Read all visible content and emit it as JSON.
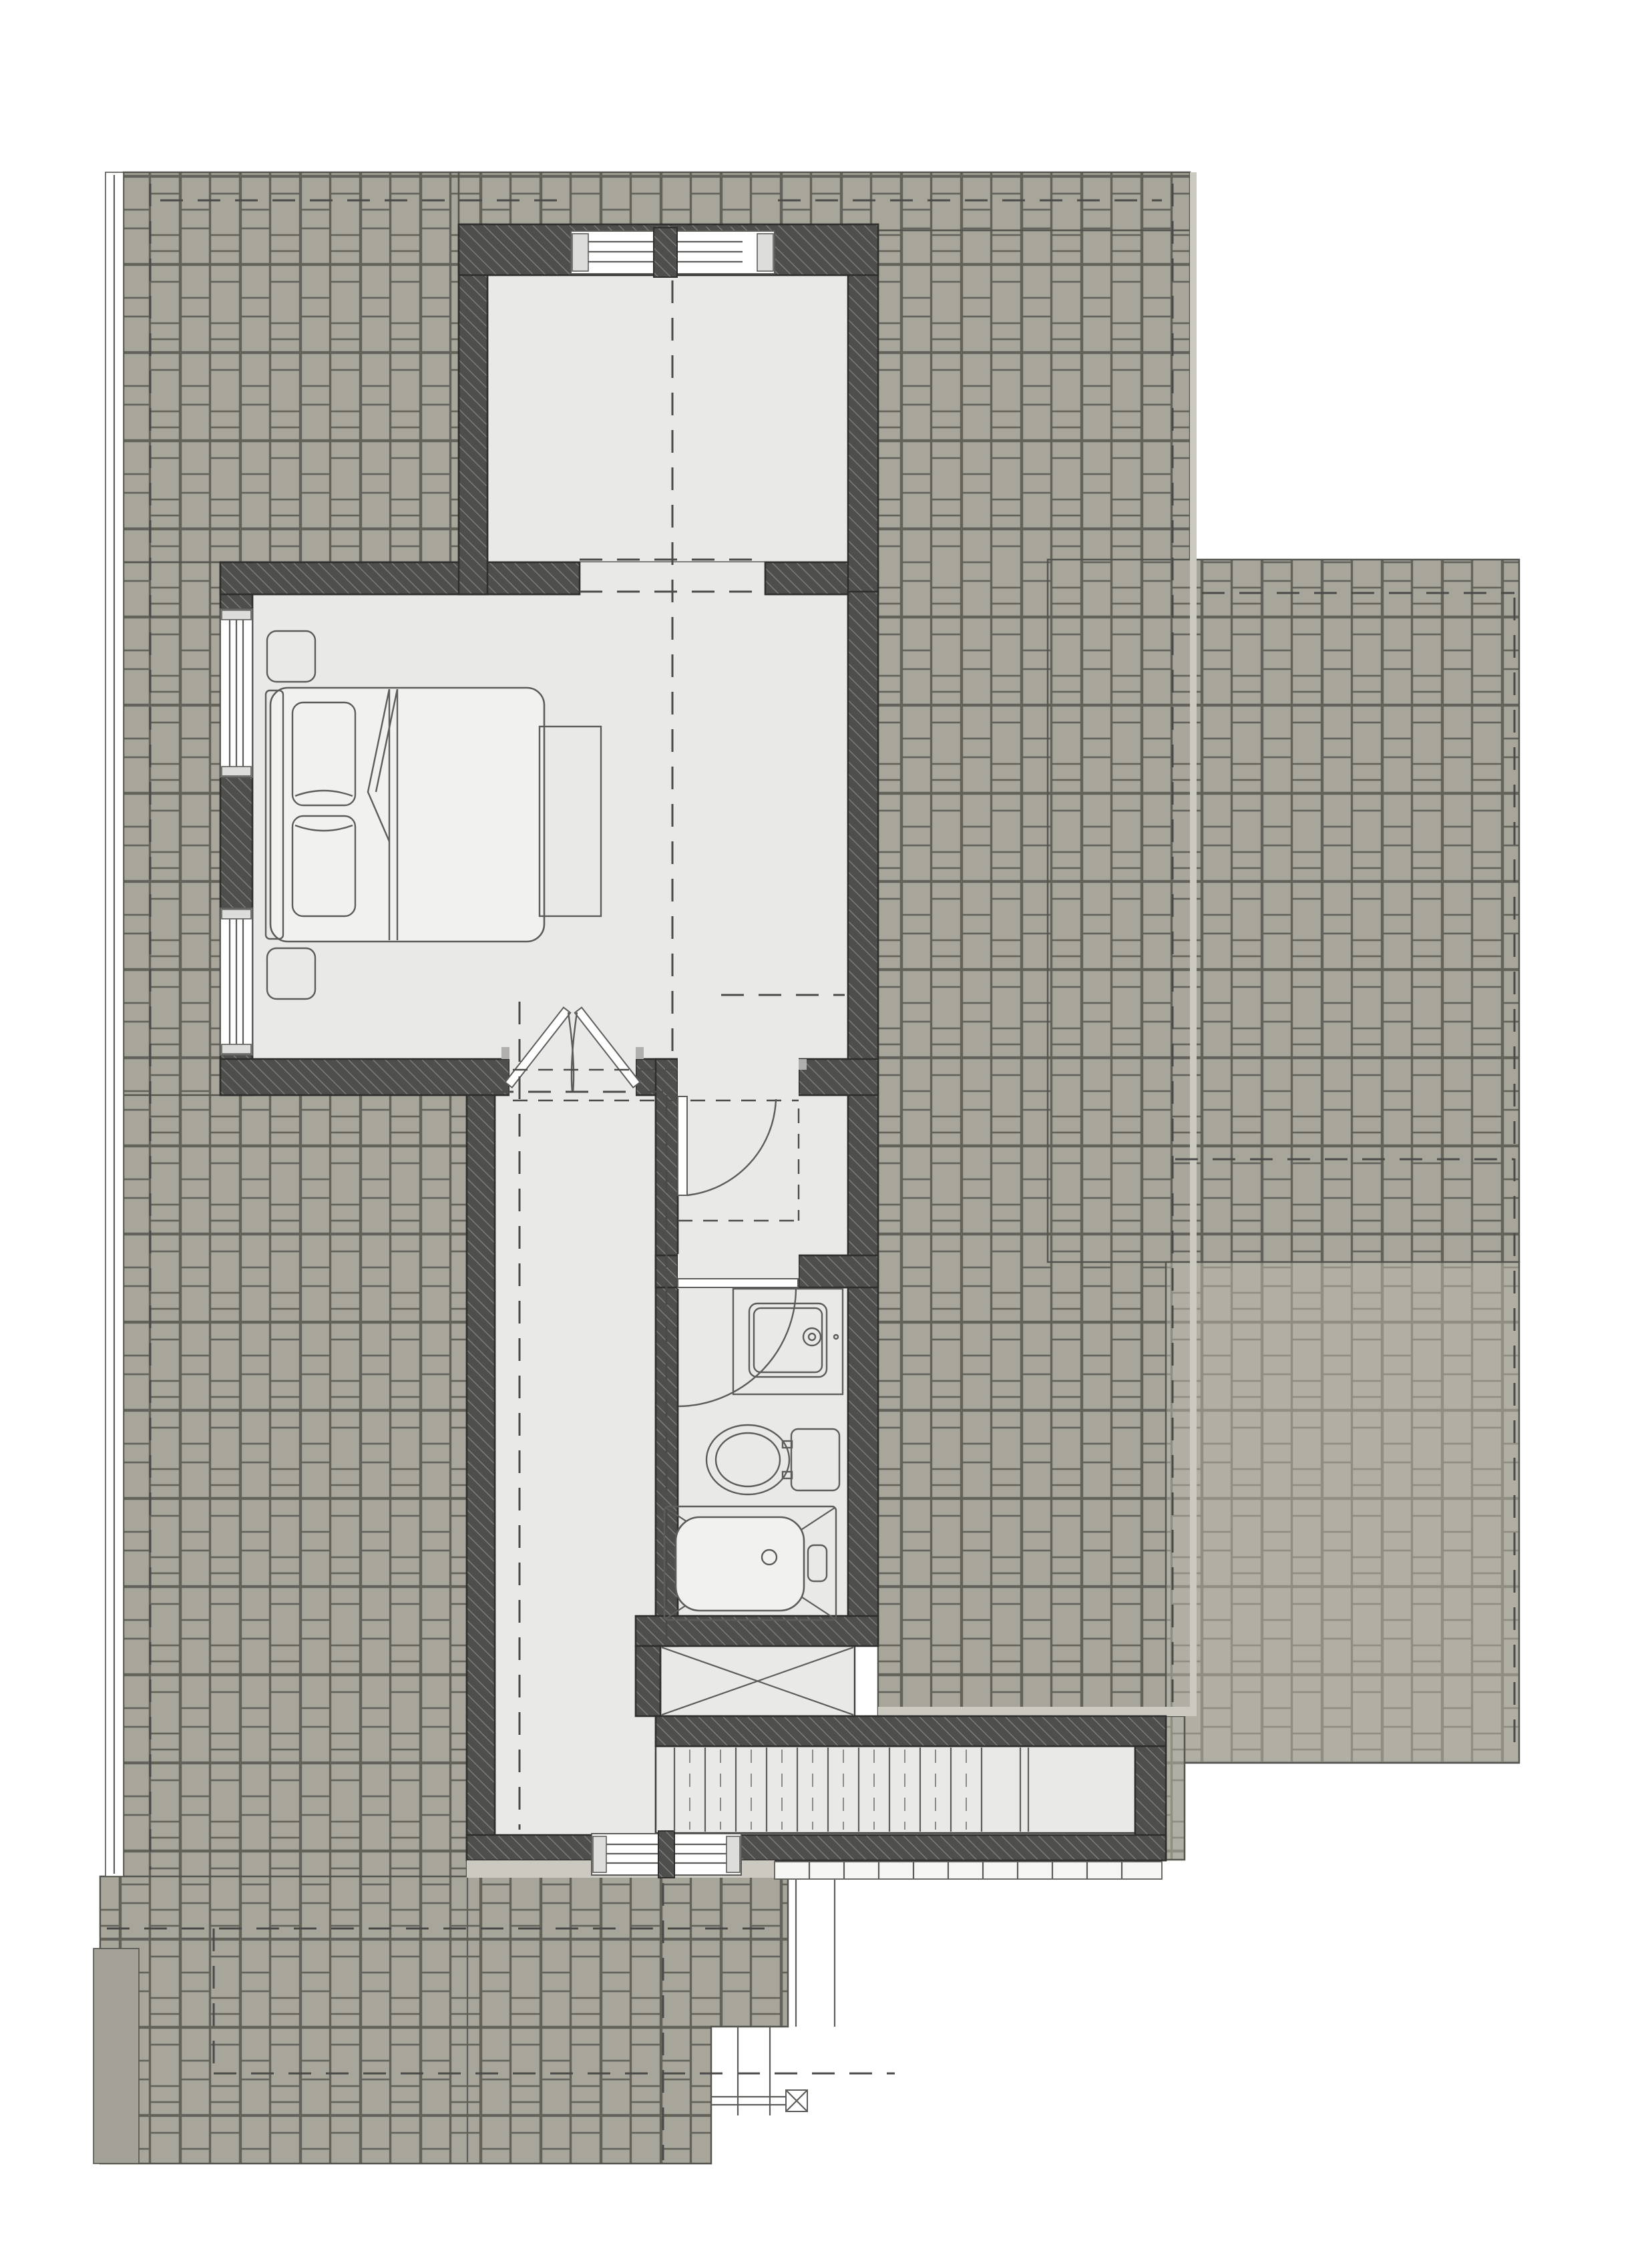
{
  "meta": {
    "drawing_type": "architectural floor plan",
    "level": "upper floor with surrounding roof planes",
    "visible_text": []
  },
  "palette": {
    "page": "#ffffff",
    "roof_fill": "#a8a69b",
    "roof_joint": "#63635c",
    "roof_fill_light": "#b1afa4",
    "roof_joint_light": "#908e83",
    "roof_edge": "#55554f",
    "eave": "#ccc9c0",
    "wall": "#4e4e4c",
    "wall_hatch": "#7d7d7a",
    "outline": "#2e2e2d",
    "interior": "#e9e9e8",
    "room_edge": "#3c3c3a",
    "fixture_stroke": "#5c5c59",
    "fixture_fill": "#f1f1f0",
    "dash": "#4a4a48",
    "deck_strip": "#a3a198"
  },
  "rooms": [
    {
      "id": "bonus-room"
    },
    {
      "id": "bedroom"
    },
    {
      "id": "hallway"
    },
    {
      "id": "walk-in-closet"
    },
    {
      "id": "bathroom"
    },
    {
      "id": "linen-closet"
    },
    {
      "id": "stairwell"
    }
  ],
  "fixtures": [
    {
      "id": "bed",
      "parts": [
        "headboard",
        "pillow",
        "pillow",
        "folded-sheet"
      ]
    },
    {
      "id": "nightstand",
      "count": 2
    },
    {
      "id": "foot-bench"
    },
    {
      "id": "vanity-sink"
    },
    {
      "id": "toilet"
    },
    {
      "id": "bathtub"
    },
    {
      "id": "double-french-door"
    },
    {
      "id": "closet-door"
    },
    {
      "id": "bathroom-door"
    }
  ],
  "windows": [
    {
      "id": "bonus-room-double-window"
    },
    {
      "id": "bedroom-window-upper"
    },
    {
      "id": "bedroom-window-lower"
    },
    {
      "id": "hall-double-window"
    }
  ],
  "stairs": {
    "tread_count": 11,
    "direction": "horizontal"
  },
  "symbols": [
    {
      "id": "linen-closet-x"
    },
    {
      "id": "bathtub-x"
    },
    {
      "id": "chimney-post-x"
    }
  ]
}
